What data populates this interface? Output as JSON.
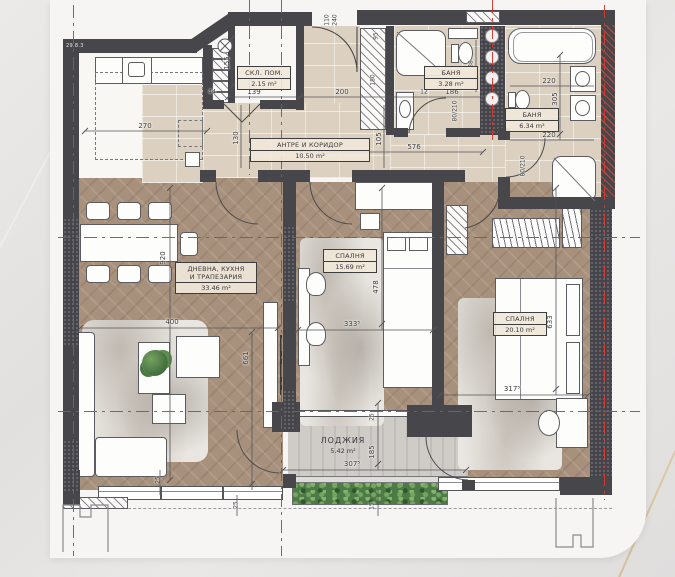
{
  "meta": {
    "corner_tag": "29.8.3"
  },
  "rooms": {
    "storage": {
      "name": "СКЛ. ПОМ.",
      "area": "2.15 m²"
    },
    "bath1": {
      "name": "БАНЯ",
      "area": "3.28 m²"
    },
    "bath2": {
      "name": "БАНЯ",
      "area": "6.34 m²"
    },
    "corridor": {
      "name": "АНТРЕ И КОРИДОР",
      "area": "10.50 m²"
    },
    "living": {
      "name_line1": "ДНЕВНА, КУХНЯ",
      "name_line2": "И ТРАПЕЗАРИЯ",
      "area": "33.46 m²"
    },
    "bedroom1": {
      "name": "СПАЛНЯ",
      "area": "15.69 m²"
    },
    "bedroom2": {
      "name": "СПАЛНЯ",
      "area": "20.10 m²"
    },
    "loggia": {
      "name": "ЛОДЖИЯ",
      "area": "5.42 m²"
    }
  },
  "dims": {
    "k270": "270",
    "k155": "155",
    "k139": "139",
    "k44": "44",
    "k130": "130",
    "k200": "200",
    "k12": "12",
    "k576": "576",
    "k105": "105",
    "k186": "186",
    "k88": "88",
    "k220a": "220",
    "k305": "305",
    "k220b": "220",
    "k920": "920",
    "k400": "400",
    "k661": "661",
    "k478": "478",
    "k3335": "333⁵",
    "k633": "633",
    "k3175": "317⁵",
    "k3075": "307⁵",
    "k185": "185",
    "k25a": "25",
    "k15": "15",
    "k25b": "25",
    "k25c": "25",
    "k80210a": "80/210",
    "k80210b": "80/210",
    "k110": "110",
    "k240": "240",
    "k95": "95",
    "k180": "180"
  }
}
